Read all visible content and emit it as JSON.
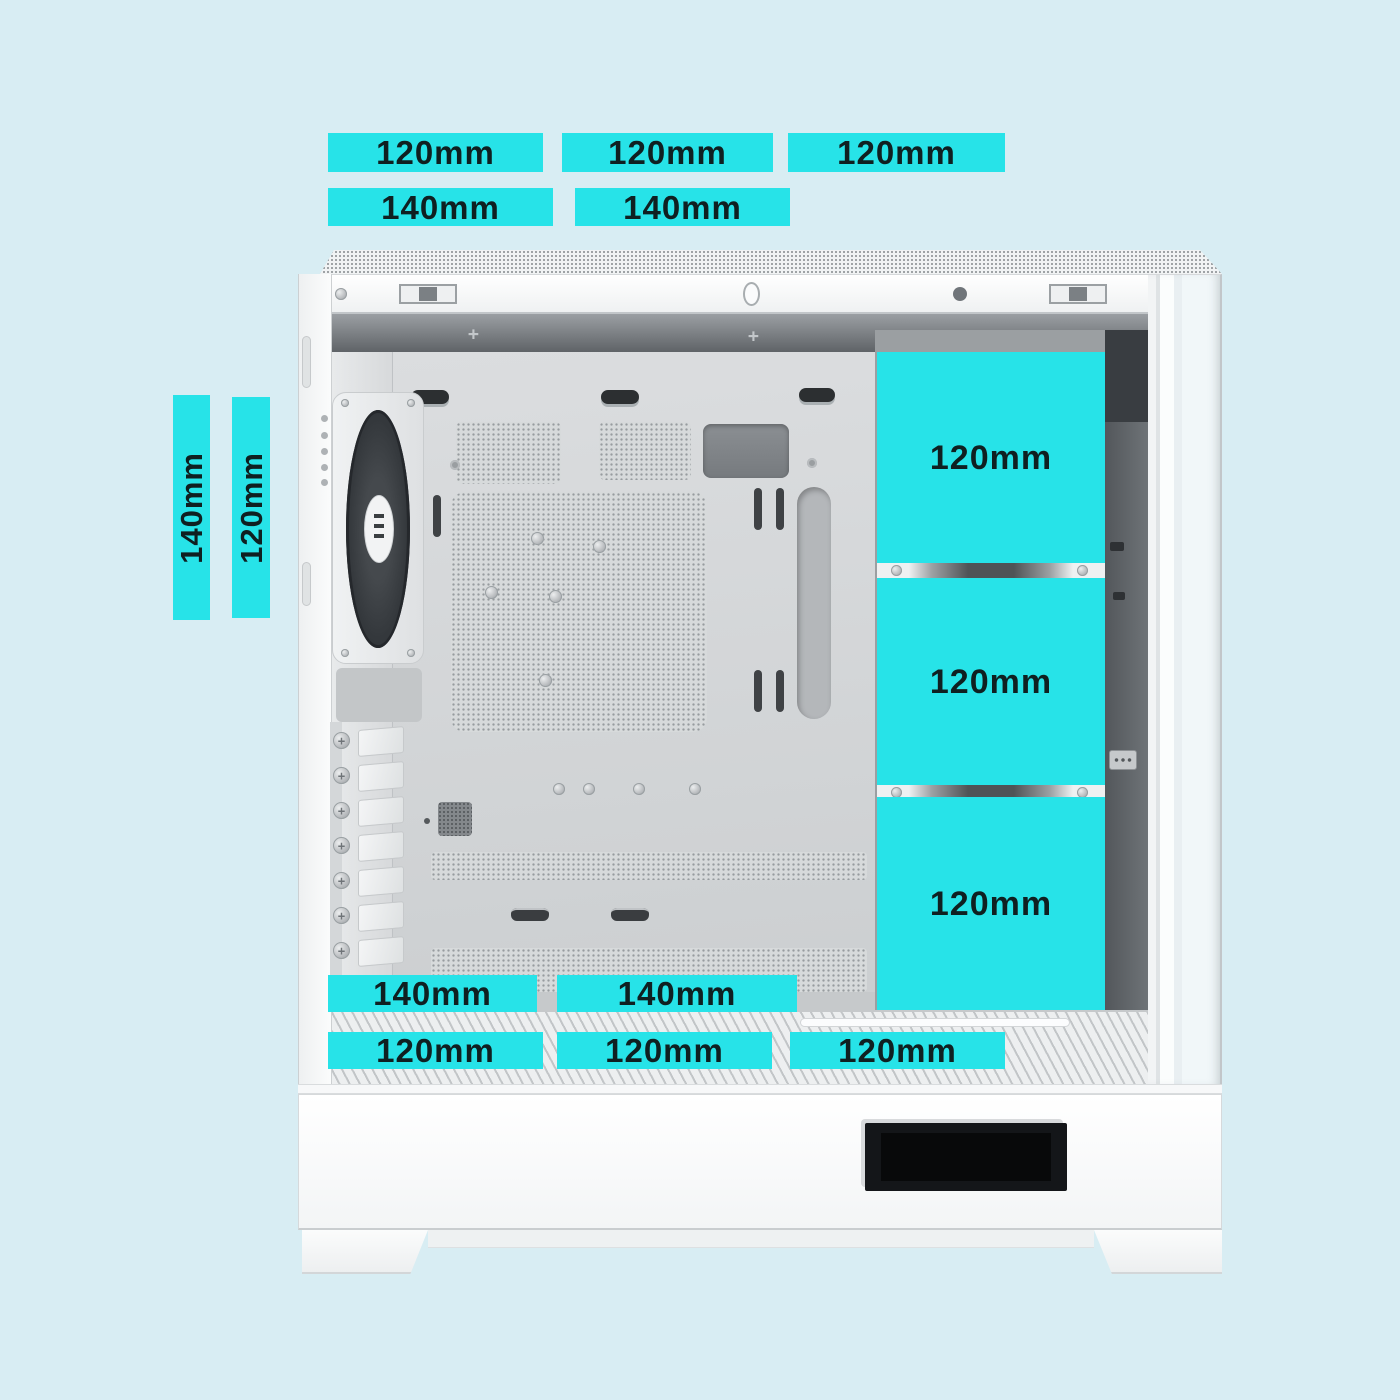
{
  "scene": {
    "background_color": "#d8edf3",
    "accent_color": "#27e3e8",
    "label_text_color": "#0f2021"
  },
  "fan_size_labels": {
    "top_120_row": [
      "120mm",
      "120mm",
      "120mm"
    ],
    "top_140_row": [
      "140mm",
      "140mm"
    ],
    "rear_vertical": [
      "140mm",
      "120mm"
    ],
    "front_column": [
      "120mm",
      "120mm",
      "120mm"
    ],
    "bottom_140_row": [
      "140mm",
      "140mm"
    ],
    "bottom_120_row": [
      "120mm",
      "120mm",
      "120mm"
    ]
  }
}
